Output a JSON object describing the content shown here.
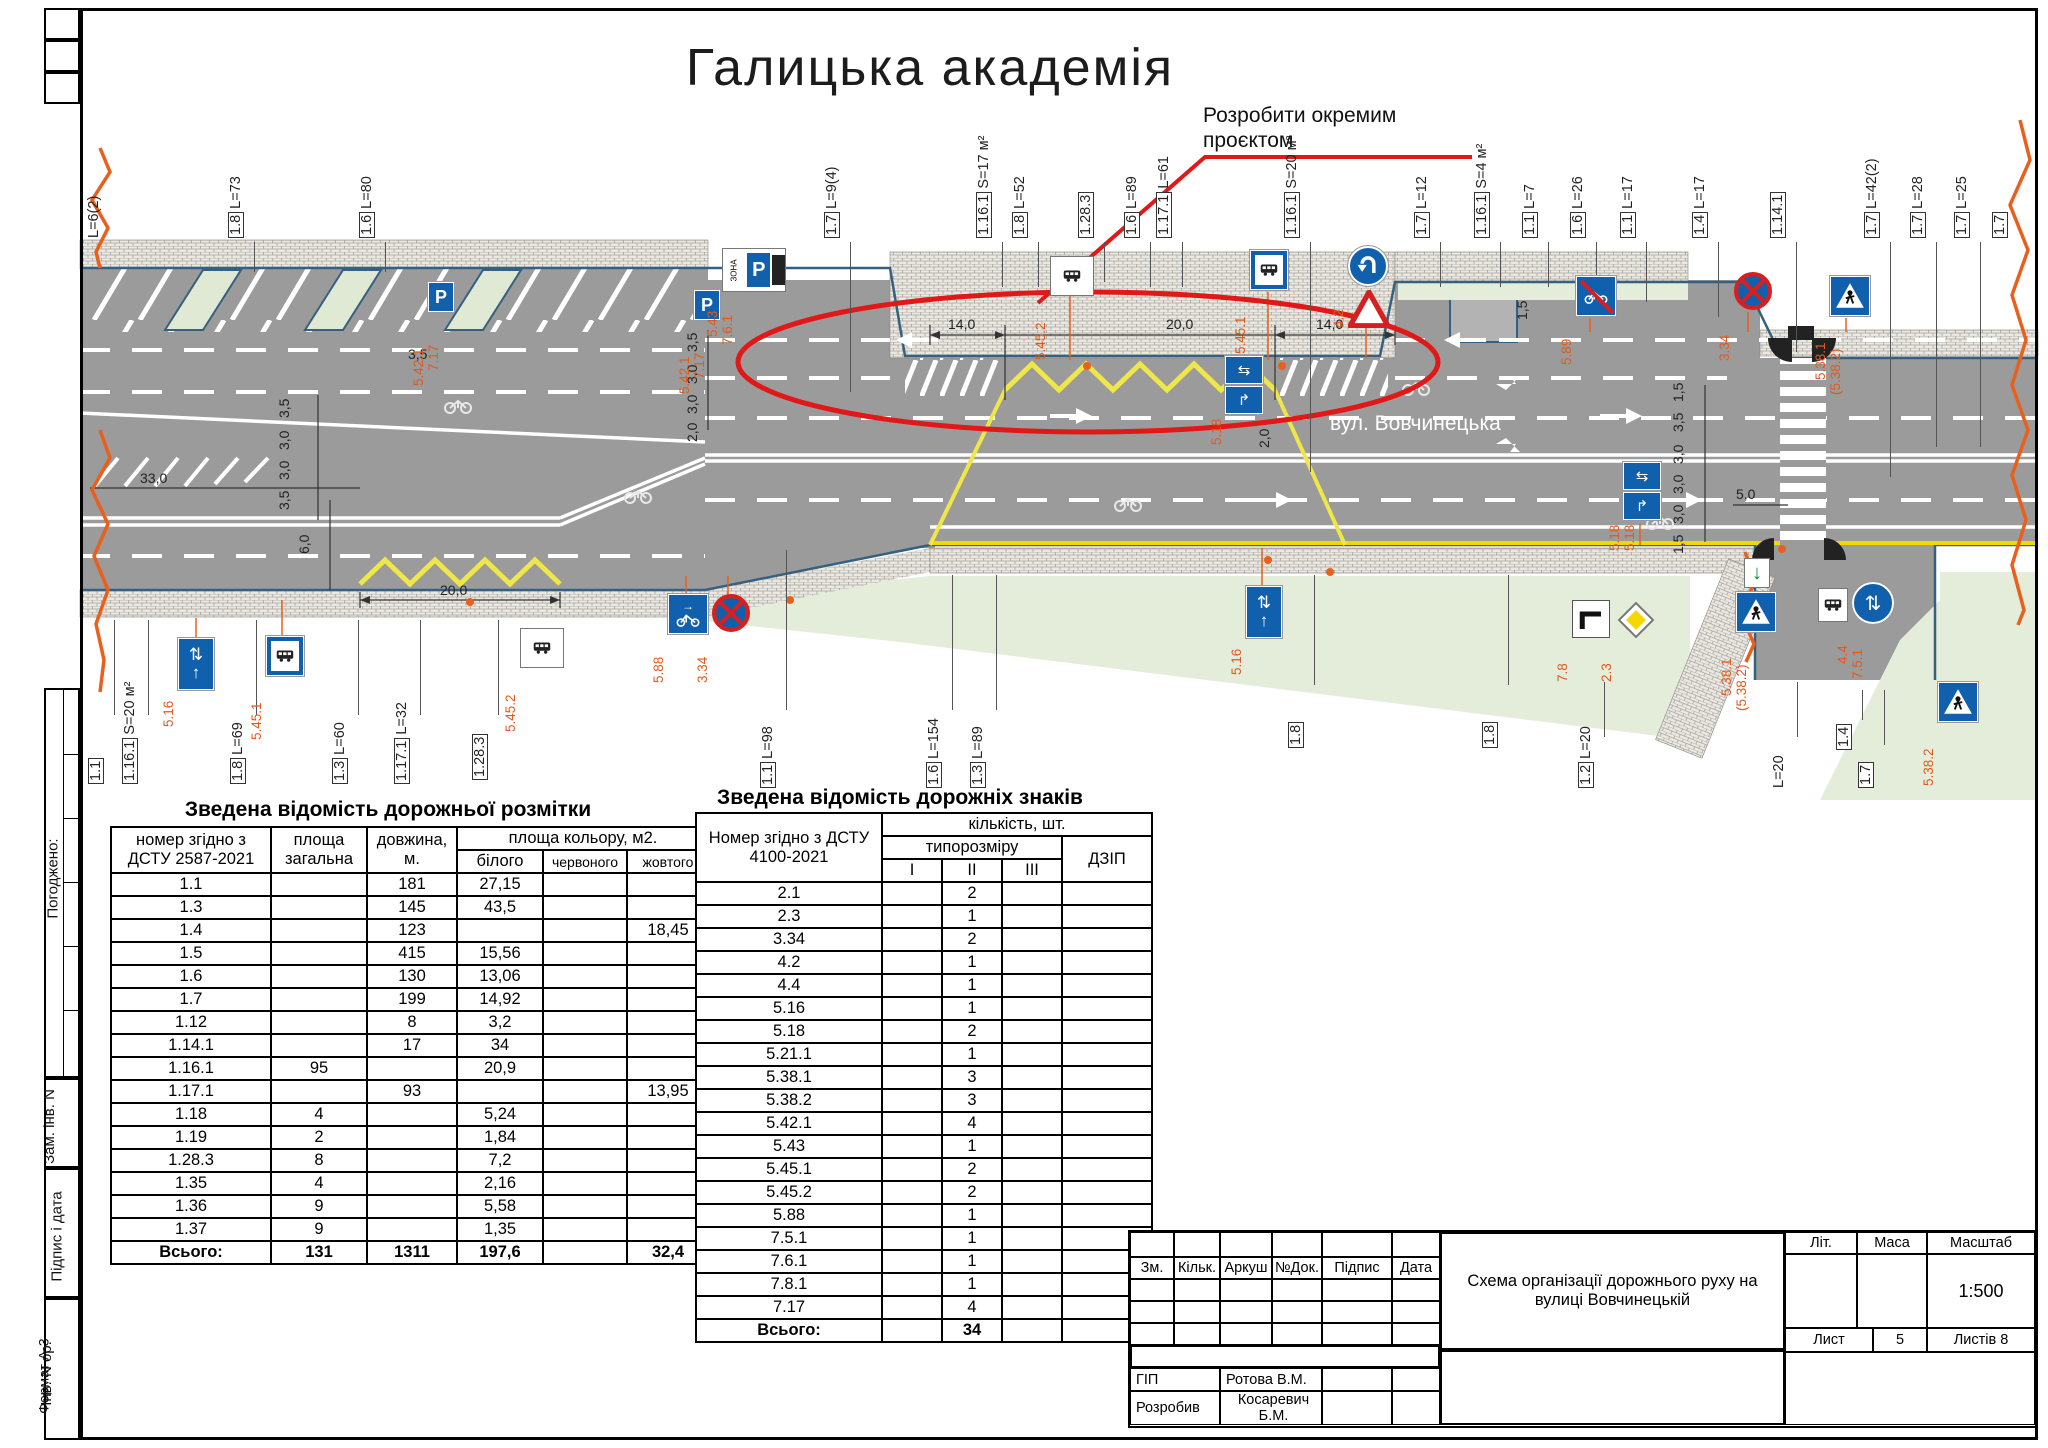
{
  "sheet": {
    "title": "Галицька академія",
    "annotation_line1": "Розробити окремим",
    "annotation_line2": "проєктом",
    "street": "вул. Вовчинецька",
    "format_label": "Формат А-3"
  },
  "side": {
    "agreed": "Погоджено:",
    "zam": "Зам. інв. N",
    "sign_date": "Підпис і дата",
    "inv": "Інв. N ор."
  },
  "marking_table": {
    "title": "Зведена відомість дорожньої розмітки",
    "h_num": "номер згідно з ДСТУ 2587-2021",
    "h_area": "площа загальна",
    "h_len": "довжина, м.",
    "h_color": "площа кольору, м2.",
    "h_white": "білого",
    "h_red": "червоного",
    "h_yellow": "жовтого",
    "rows": [
      [
        "1.1",
        "",
        "181",
        "27,15",
        "",
        ""
      ],
      [
        "1.3",
        "",
        "145",
        "43,5",
        "",
        ""
      ],
      [
        "1.4",
        "",
        "123",
        "",
        "",
        "18,45"
      ],
      [
        "1.5",
        "",
        "415",
        "15,56",
        "",
        ""
      ],
      [
        "1.6",
        "",
        "130",
        "13,06",
        "",
        ""
      ],
      [
        "1.7",
        "",
        "199",
        "14,92",
        "",
        ""
      ],
      [
        "1.12",
        "",
        "8",
        "3,2",
        "",
        ""
      ],
      [
        "1.14.1",
        "",
        "17",
        "34",
        "",
        ""
      ],
      [
        "1.16.1",
        "95",
        "",
        "20,9",
        "",
        ""
      ],
      [
        "1.17.1",
        "",
        "93",
        "",
        "",
        "13,95"
      ],
      [
        "1.18",
        "4",
        "",
        "5,24",
        "",
        ""
      ],
      [
        "1.19",
        "2",
        "",
        "1,84",
        "",
        ""
      ],
      [
        "1.28.3",
        "8",
        "",
        "7,2",
        "",
        ""
      ],
      [
        "1.35",
        "4",
        "",
        "2,16",
        "",
        ""
      ],
      [
        "1.36",
        "9",
        "",
        "5,58",
        "",
        ""
      ],
      [
        "1.37",
        "9",
        "",
        "1,35",
        "",
        ""
      ]
    ],
    "total_label": "Всього:",
    "total": [
      "131",
      "1311",
      "197,6",
      "",
      "32,4"
    ]
  },
  "signs_table": {
    "title": "Зведена відомість дорожніх знаків",
    "h_num": "Номер згідно з ДСТУ 4100-2021",
    "h_qty": "кількість, шт.",
    "h_size": "типорозміру",
    "h_i": "I",
    "h_ii": "II",
    "h_iii": "III",
    "h_dzip": "ДЗІП",
    "rows": [
      [
        "2.1",
        "",
        "2",
        "",
        ""
      ],
      [
        "2.3",
        "",
        "1",
        "",
        ""
      ],
      [
        "3.34",
        "",
        "2",
        "",
        ""
      ],
      [
        "4.2",
        "",
        "1",
        "",
        ""
      ],
      [
        "4.4",
        "",
        "1",
        "",
        ""
      ],
      [
        "5.16",
        "",
        "1",
        "",
        ""
      ],
      [
        "5.18",
        "",
        "2",
        "",
        ""
      ],
      [
        "5.21.1",
        "",
        "1",
        "",
        ""
      ],
      [
        "5.38.1",
        "",
        "3",
        "",
        ""
      ],
      [
        "5.38.2",
        "",
        "3",
        "",
        ""
      ],
      [
        "5.42.1",
        "",
        "4",
        "",
        ""
      ],
      [
        "5.43",
        "",
        "1",
        "",
        ""
      ],
      [
        "5.45.1",
        "",
        "2",
        "",
        ""
      ],
      [
        "5.45.2",
        "",
        "2",
        "",
        ""
      ],
      [
        "5.88",
        "",
        "1",
        "",
        ""
      ],
      [
        "7.5.1",
        "",
        "1",
        "",
        ""
      ],
      [
        "7.6.1",
        "",
        "1",
        "",
        ""
      ],
      [
        "7.8.1",
        "",
        "1",
        "",
        ""
      ],
      [
        "7.17",
        "",
        "4",
        "",
        ""
      ]
    ],
    "total_label": "Всього:",
    "total_value": "34"
  },
  "stamp": {
    "c_zm": "Зм.",
    "c_kilk": "Кільк.",
    "c_arkush": "Аркуш",
    "c_doc": "№Док.",
    "c_pidpys": "Підпис",
    "c_data": "Дата",
    "title": "Схема організації дорожнього руху на вулиці Вовчинецькій",
    "lit": "Літ.",
    "mass": "Маса",
    "scale_label": "Масштаб",
    "scale": "1:500",
    "sheet_label": "Лист",
    "sheet_no": "5",
    "sheets_label": "Листів 8",
    "r1_role": "ГІП",
    "r1_name": "Ротова В.М.",
    "r2_role": "Розробив",
    "r2_name": "Косаревич Б.М."
  },
  "plan": {
    "top_callouts": [
      {
        "n": "",
        "t": "L=6(2)",
        "x": 112,
        "lh": 0
      },
      {
        "n": "1.8",
        "t": "L=73",
        "x": 254,
        "lh": 30
      },
      {
        "n": "1.6",
        "t": "L=80",
        "x": 385,
        "lh": 30
      },
      {
        "n": "1.7",
        "t": "L=9(4)",
        "x": 850,
        "lh": 150
      },
      {
        "n": "1.16.1",
        "t": "S=17 м²",
        "x": 1002,
        "lh": 45
      },
      {
        "n": "1.8",
        "t": "L=52",
        "x": 1038,
        "lh": 45
      },
      {
        "n": "1.28.3",
        "t": "",
        "x": 1104,
        "lh": 40
      },
      {
        "n": "1.6",
        "t": "L=89",
        "x": 1150,
        "lh": 45
      },
      {
        "n": "1.17.1",
        "t": "L=61",
        "x": 1182,
        "lh": 45
      },
      {
        "n": "1.16.1",
        "t": "S=20 м²",
        "x": 1310,
        "lh": 230
      },
      {
        "n": "1.7",
        "t": "L=12",
        "x": 1440,
        "lh": 45
      },
      {
        "n": "1.16.1",
        "t": "S=4 м²",
        "x": 1500,
        "lh": 45
      },
      {
        "n": "1.1",
        "t": "L=7",
        "x": 1548,
        "lh": 45
      },
      {
        "n": "1.6",
        "t": "L=26",
        "x": 1596,
        "lh": 45
      },
      {
        "n": "1.1",
        "t": "L=17",
        "x": 1646,
        "lh": 60
      },
      {
        "n": "1.4",
        "t": "L=17",
        "x": 1718,
        "lh": 75
      },
      {
        "n": "1.14.1",
        "t": "",
        "x": 1796,
        "lh": 110
      },
      {
        "n": "1.7",
        "t": "L=42(2)",
        "x": 1890,
        "lh": 235
      },
      {
        "n": "1.7",
        "t": "L=28",
        "x": 1936,
        "lh": 205
      },
      {
        "n": "1.7",
        "t": "L=25",
        "x": 1980,
        "lh": 205
      },
      {
        "n": "1.7",
        "t": "",
        "x": 2018,
        "lh": 0
      }
    ],
    "bottom_callouts": [
      {
        "n": "1.1",
        "t": "",
        "x": 114,
        "y": 784,
        "lt": 620,
        "lh": 95
      },
      {
        "n": "1.16.1",
        "t": "S=20 м²",
        "x": 148,
        "y": 784,
        "lt": 620,
        "lh": 95
      },
      {
        "n": "1.8",
        "t": "L=69",
        "x": 256,
        "y": 784,
        "lt": 620,
        "lh": 95
      },
      {
        "n": "1.3",
        "t": "L=60",
        "x": 358,
        "y": 784,
        "lt": 620,
        "lh": 95
      },
      {
        "n": "1.17.1",
        "t": "L=32",
        "x": 420,
        "y": 784,
        "lt": 620,
        "lh": 95
      },
      {
        "n": "1.28.3",
        "t": "",
        "x": 498,
        "y": 780,
        "lt": 620,
        "lh": 95
      },
      {
        "n": "1.1",
        "t": "L=98",
        "x": 786,
        "y": 788,
        "lt": 550,
        "lh": 160
      },
      {
        "n": "1.6",
        "t": "L=154",
        "x": 952,
        "y": 788,
        "lt": 575,
        "lh": 135
      },
      {
        "n": "1.3",
        "t": "L=89",
        "x": 996,
        "y": 788,
        "lt": 575,
        "lh": 135
      },
      {
        "n": "1.8",
        "t": "",
        "x": 1314,
        "y": 748,
        "lt": 575,
        "lh": 110
      },
      {
        "n": "1.8",
        "t": "",
        "x": 1508,
        "y": 748,
        "lt": 575,
        "lh": 110
      },
      {
        "n": "1.2",
        "t": "L=20",
        "x": 1604,
        "y": 788,
        "lt": 682,
        "lh": 55
      },
      {
        "n": "",
        "t": "L=20",
        "x": 1797,
        "y": 788,
        "lt": 682,
        "lh": 55
      },
      {
        "n": "1.4",
        "t": "",
        "x": 1862,
        "y": 750,
        "lt": 690,
        "lh": 30
      },
      {
        "n": "1.7",
        "t": "",
        "x": 1884,
        "y": 788,
        "lt": 690,
        "lh": 55
      }
    ],
    "dims": [
      {
        "t": "33,0",
        "x": 140,
        "y": 470
      },
      {
        "t": "3,5",
        "x": 292,
        "y": 402,
        "r": 1
      },
      {
        "t": "3,0",
        "x": 292,
        "y": 434,
        "r": 1
      },
      {
        "t": "3,0",
        "x": 292,
        "y": 464,
        "r": 1
      },
      {
        "t": "3,5",
        "x": 292,
        "y": 494,
        "r": 1
      },
      {
        "t": "6,0",
        "x": 312,
        "y": 538,
        "r": 1
      },
      {
        "t": "20,0",
        "x": 440,
        "y": 582
      },
      {
        "t": "3,5",
        "x": 408,
        "y": 346
      },
      {
        "t": "3,5",
        "x": 700,
        "y": 336,
        "r": 1
      },
      {
        "t": "3,0",
        "x": 700,
        "y": 368,
        "r": 1
      },
      {
        "t": "3,0",
        "x": 700,
        "y": 398,
        "r": 1
      },
      {
        "t": "2,0",
        "x": 700,
        "y": 426,
        "r": 1
      },
      {
        "t": "14,0",
        "x": 948,
        "y": 316
      },
      {
        "t": "20,0",
        "x": 1166,
        "y": 316
      },
      {
        "t": "14,0",
        "x": 1316,
        "y": 316
      },
      {
        "t": "2,0",
        "x": 1272,
        "y": 432,
        "r": 1
      },
      {
        "t": "1,5",
        "x": 1686,
        "y": 386,
        "r": 1
      },
      {
        "t": "3,5",
        "x": 1686,
        "y": 416,
        "r": 1
      },
      {
        "t": "3,0",
        "x": 1686,
        "y": 448,
        "r": 1
      },
      {
        "t": "3,0",
        "x": 1686,
        "y": 478,
        "r": 1
      },
      {
        "t": "3,0",
        "x": 1686,
        "y": 508,
        "r": 1
      },
      {
        "t": "1,5",
        "x": 1686,
        "y": 538,
        "r": 1
      },
      {
        "t": "5,0",
        "x": 1736,
        "y": 486
      },
      {
        "t": "1,5",
        "x": 1530,
        "y": 304,
        "r": 1
      }
    ],
    "signs": [
      {
        "k": "p",
        "x": 428,
        "y": 282,
        "lb": "5.42.1",
        "lb2": "7.17"
      },
      {
        "k": "p",
        "x": 694,
        "y": 290,
        "lb": "5.42.1",
        "lb2": "7.17"
      },
      {
        "k": "zonep",
        "x": 722,
        "y": 248,
        "lb": "5.43",
        "lb2": "7.6.1"
      },
      {
        "k": "busw",
        "x": 1050,
        "y": 256,
        "lb": "5.45.2"
      },
      {
        "k": "busb",
        "x": 1250,
        "y": 250,
        "lb": "5.45.1"
      },
      {
        "k": "turn",
        "x": 1348,
        "y": 246,
        "lb": "4.2"
      },
      {
        "k": "redtri",
        "x": 1348,
        "y": 290
      },
      {
        "k": "nobike",
        "x": 1576,
        "y": 276,
        "lb": "5.89"
      },
      {
        "k": "nostop",
        "x": 1734,
        "y": 272,
        "lb": "3.34"
      },
      {
        "k": "pedtri",
        "x": 1830,
        "y": 276,
        "lb": "5.38.1",
        "lb2": "(5.38.2)"
      },
      {
        "k": "lane16",
        "x": 178,
        "y": 638,
        "lb": "5.16"
      },
      {
        "k": "busb",
        "x": 266,
        "y": 636,
        "lb": "5.45.1"
      },
      {
        "k": "busw",
        "x": 520,
        "y": 628,
        "lb": "5.45.2"
      },
      {
        "k": "bikearr",
        "x": 668,
        "y": 594,
        "lb": "5.88"
      },
      {
        "k": "nostop",
        "x": 712,
        "y": 594,
        "lb": "3.34"
      },
      {
        "k": "lane16",
        "x": 1246,
        "y": 586,
        "lb": "5.16"
      },
      {
        "k": "lane18",
        "x": 1624,
        "y": 462,
        "lb": "5.18",
        "lb2": "5.18"
      },
      {
        "k": "lane18",
        "x": 1226,
        "y": 356,
        "lb": "5.18"
      },
      {
        "k": "sq78",
        "x": 1572,
        "y": 600,
        "lb": "7.8"
      },
      {
        "k": "diam",
        "x": 1616,
        "y": 600,
        "lb": "2.3"
      },
      {
        "k": "garr",
        "x": 1744,
        "y": 558
      },
      {
        "k": "pedtri",
        "x": 1736,
        "y": 592,
        "lb": "5.38.1",
        "lb2": "(5.38.2)"
      },
      {
        "k": "plate",
        "x": 1818,
        "y": 588
      },
      {
        "k": "c44",
        "x": 1852,
        "y": 582,
        "lb": "4.4",
        "lb2": "7.5.1"
      },
      {
        "k": "pedtri",
        "x": 1938,
        "y": 682,
        "lb": "5.38.2"
      }
    ]
  }
}
